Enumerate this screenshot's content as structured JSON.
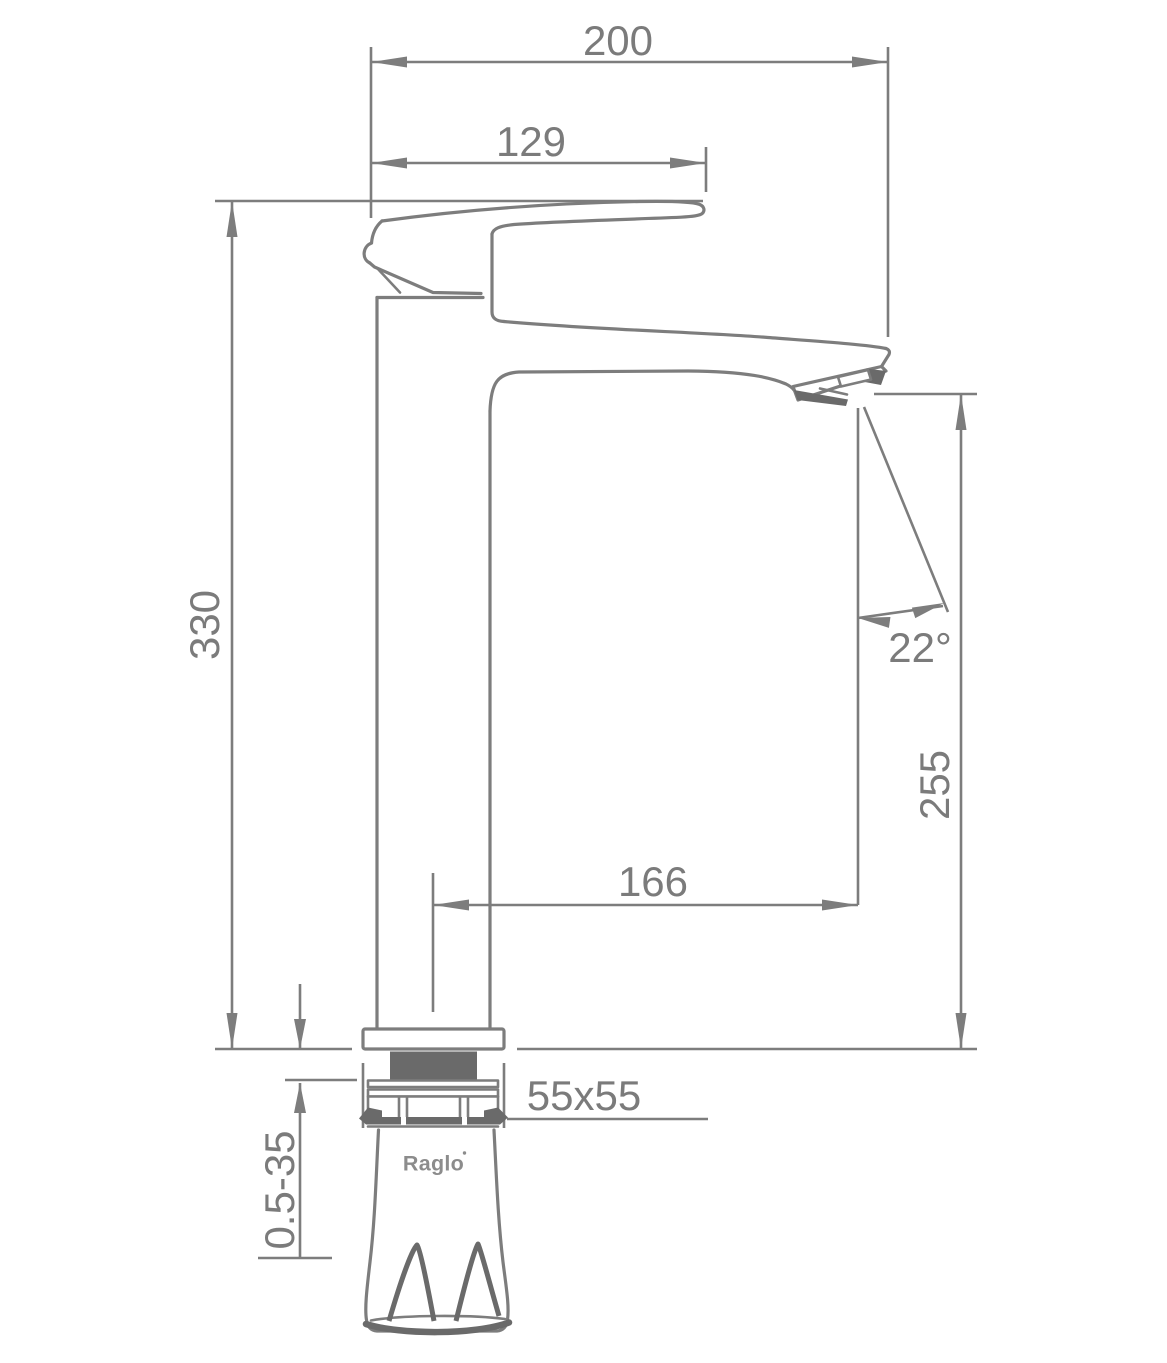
{
  "drawing": {
    "type": "faucet-technical-dimension-drawing",
    "background": "#ffffff",
    "line_color": "#7d7d7d",
    "dark_fill": "#6a6a6a",
    "text_color": "#7b7b7b"
  },
  "brand": {
    "name": "Raglo"
  },
  "dimensions": {
    "overall_width": "200",
    "handle_length": "129",
    "total_height": "330",
    "spout_angle": "22°",
    "spout_outlet_height": "255",
    "spout_reach": "166",
    "base_plate": "55x55",
    "deck_thickness_range": "0.5-35"
  }
}
